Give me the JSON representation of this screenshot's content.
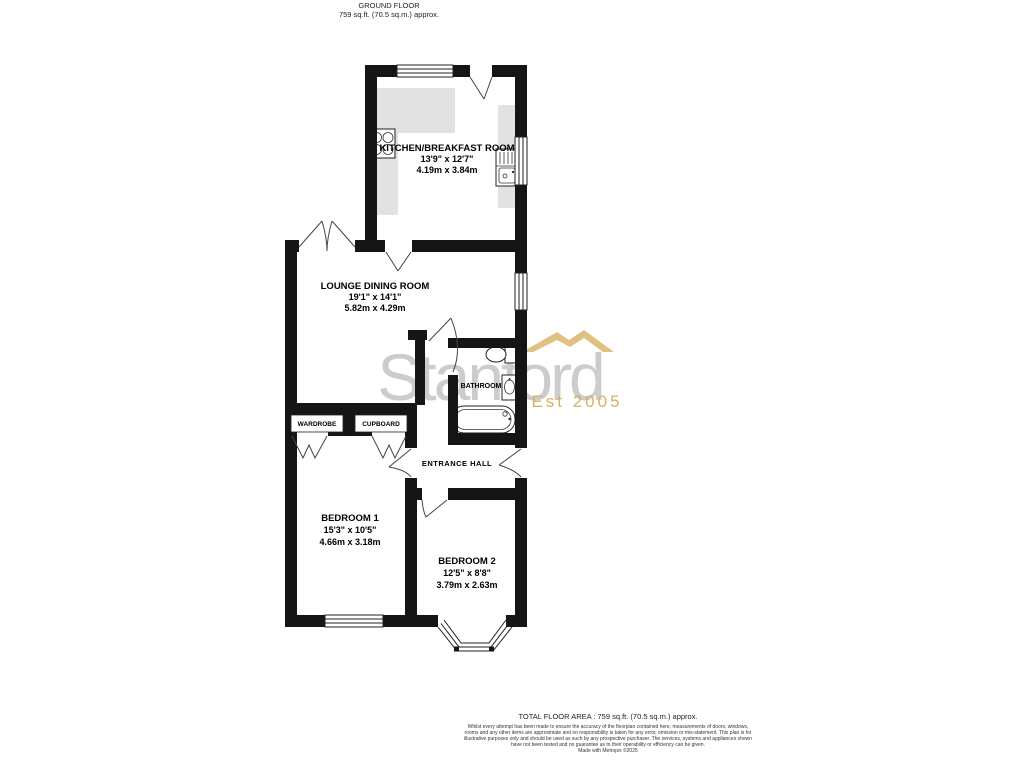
{
  "header": {
    "title": "GROUND FLOOR",
    "area": "759 sq.ft. (70.5 sq.m.) approx."
  },
  "rooms": [
    {
      "name": "KITCHEN/BREAKFAST ROOM",
      "imperial": "13'9\"  x 12'7\"",
      "metric": "4.19m  x 3.84m"
    },
    {
      "name": "LOUNGE DINING ROOM",
      "imperial": "19'1\"  x 14'1\"",
      "metric": "5.82m  x 4.29m"
    },
    {
      "name": "BATHROOM"
    },
    {
      "name": "ENTRANCE HALL"
    },
    {
      "name": "WARDROBE"
    },
    {
      "name": "CUPBOARD"
    },
    {
      "name": "BEDROOM 1",
      "imperial": "15'3\"  x 10'5\"",
      "metric": "4.66m  x 3.18m"
    },
    {
      "name": "BEDROOM 2",
      "imperial": "12'5\"  x 8'8\"",
      "metric": "3.79m  x 2.63m"
    }
  ],
  "watermark": {
    "name": "Stanford",
    "est": "Est 2005",
    "gray": "#c7c7c7",
    "gold": "#d4a94f"
  },
  "footer": {
    "total": "TOTAL FLOOR AREA : 759 sq.ft. (70.5 sq.m.) approx.",
    "disclaimer": "Whilst every attempt has been made to ensure the accuracy of the floorplan contained here, measurements of doors, windows, rooms and any other items are approximate and no responsibility is taken for any error, omission or mis-statement. This plan is for illustrative purposes only and should be used as such by any prospective purchaser. The services, systems and appliances shown have not been tested and no guarantee as to their operability or efficiency can be given.",
    "made_with": "Made with Metropix ©2025"
  }
}
